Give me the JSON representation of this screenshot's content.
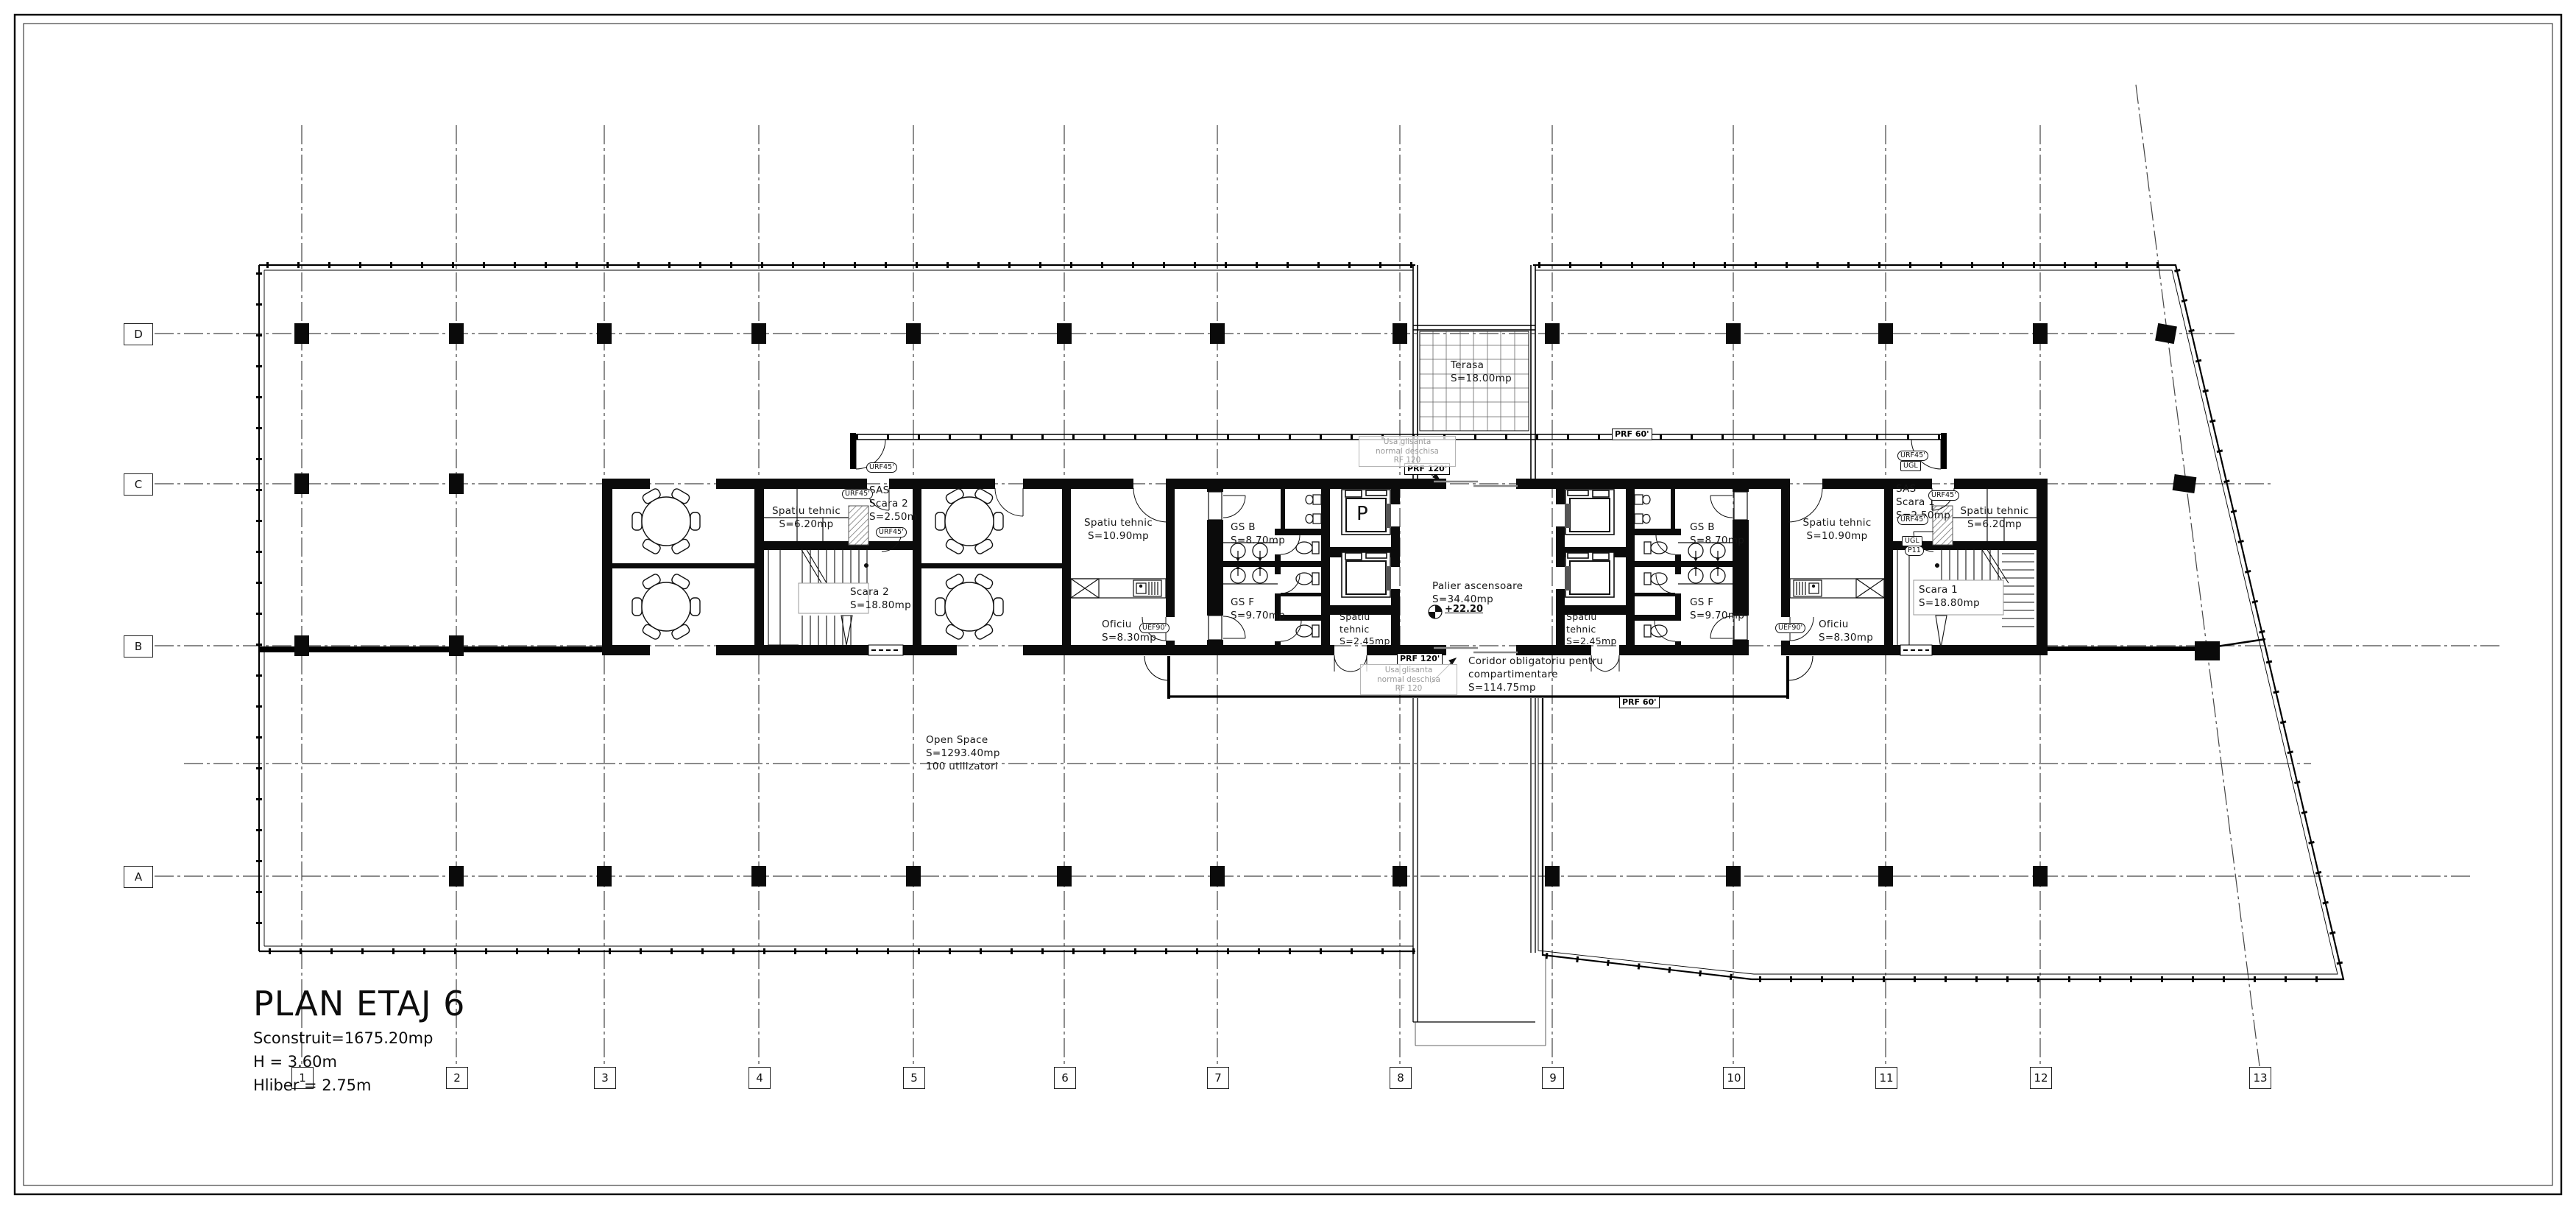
{
  "sheet": {
    "title": "PLAN ETAJ 6",
    "stat_area": "Sconstruit=1675.20mp",
    "stat_height": "H = 3.60m",
    "stat_clear": "Hliber = 2.75m"
  },
  "grid": {
    "rows": [
      "D",
      "C",
      "B",
      "A"
    ],
    "cols": [
      "1",
      "2",
      "3",
      "4",
      "5",
      "6",
      "7",
      "8",
      "9",
      "10",
      "11",
      "12",
      "13"
    ]
  },
  "rooms": {
    "spatiu_tehnic_620": {
      "name": "Spatiu tehnic",
      "area": "S=6.20mp"
    },
    "sas_scara_2": {
      "name": "SAS",
      "line2": "Scara 2",
      "area": "S=2.50m"
    },
    "scara_2": {
      "name": "Scara 2",
      "area": "S=18.80mp"
    },
    "spatiu_tehnic_1090": {
      "name": "Spatiu tehnic",
      "area": "S=10.90mp"
    },
    "oficiu": {
      "name": "Oficiu",
      "area": "S=8.30mp"
    },
    "gs_b": {
      "name": "GS B",
      "area": "S=8.70mp"
    },
    "gs_f": {
      "name": "GS F",
      "area": "S=9.70mp"
    },
    "spatiu_tehnic_245": {
      "name": "Spatiu",
      "line2": "tehnic",
      "area": "S=2.45mp"
    },
    "palier": {
      "name": "Palier ascensoare",
      "area": "S=34.40mp",
      "level": "+22.20"
    },
    "sas_scara_1": {
      "name": "SAS",
      "line2": "Scara 1",
      "area": "S=2.50mp"
    },
    "scara_1": {
      "name": "Scara 1",
      "area": "S=18.80mp"
    },
    "coridor": {
      "name": "Coridor obligatoriu pentru",
      "line2": "compartimentare",
      "area": "S=114.75mp"
    },
    "open_space": {
      "name": "Open Space",
      "area": "S=1293.40mp",
      "line3": "100 utilizatori"
    },
    "terasa": {
      "name": "Terasa",
      "area": "S=18.00mp"
    }
  },
  "door_labels": {
    "urf45": "URF45'",
    "uef90": "UEF90'",
    "ugl": "UGL",
    "p11": "P11",
    "prf120": "PRF 120'",
    "prf60": "PRF 60'"
  },
  "annotations": {
    "sliding1": "Usa glisanta",
    "sliding2": "normal deschisa",
    "sliding3": "RF 120",
    "elevator": "P"
  }
}
